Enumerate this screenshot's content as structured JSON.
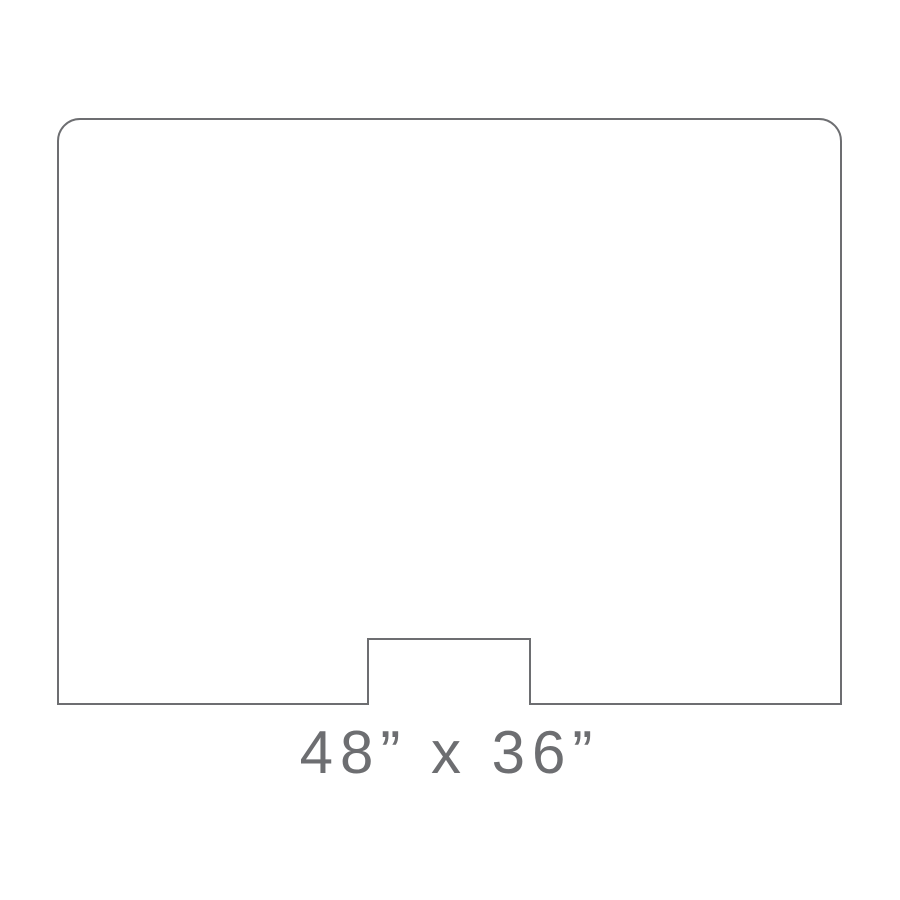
{
  "diagram": {
    "type": "product-dimension-outline",
    "shape_name": "panel-with-rounded-top-corners-and-bottom-center-notch",
    "caption": "48” x 36”",
    "width_label": "48”",
    "height_label": "36”",
    "stroke_color": "#6d6e71",
    "caption_color": "#6d6e71",
    "background_color": "#ffffff"
  }
}
